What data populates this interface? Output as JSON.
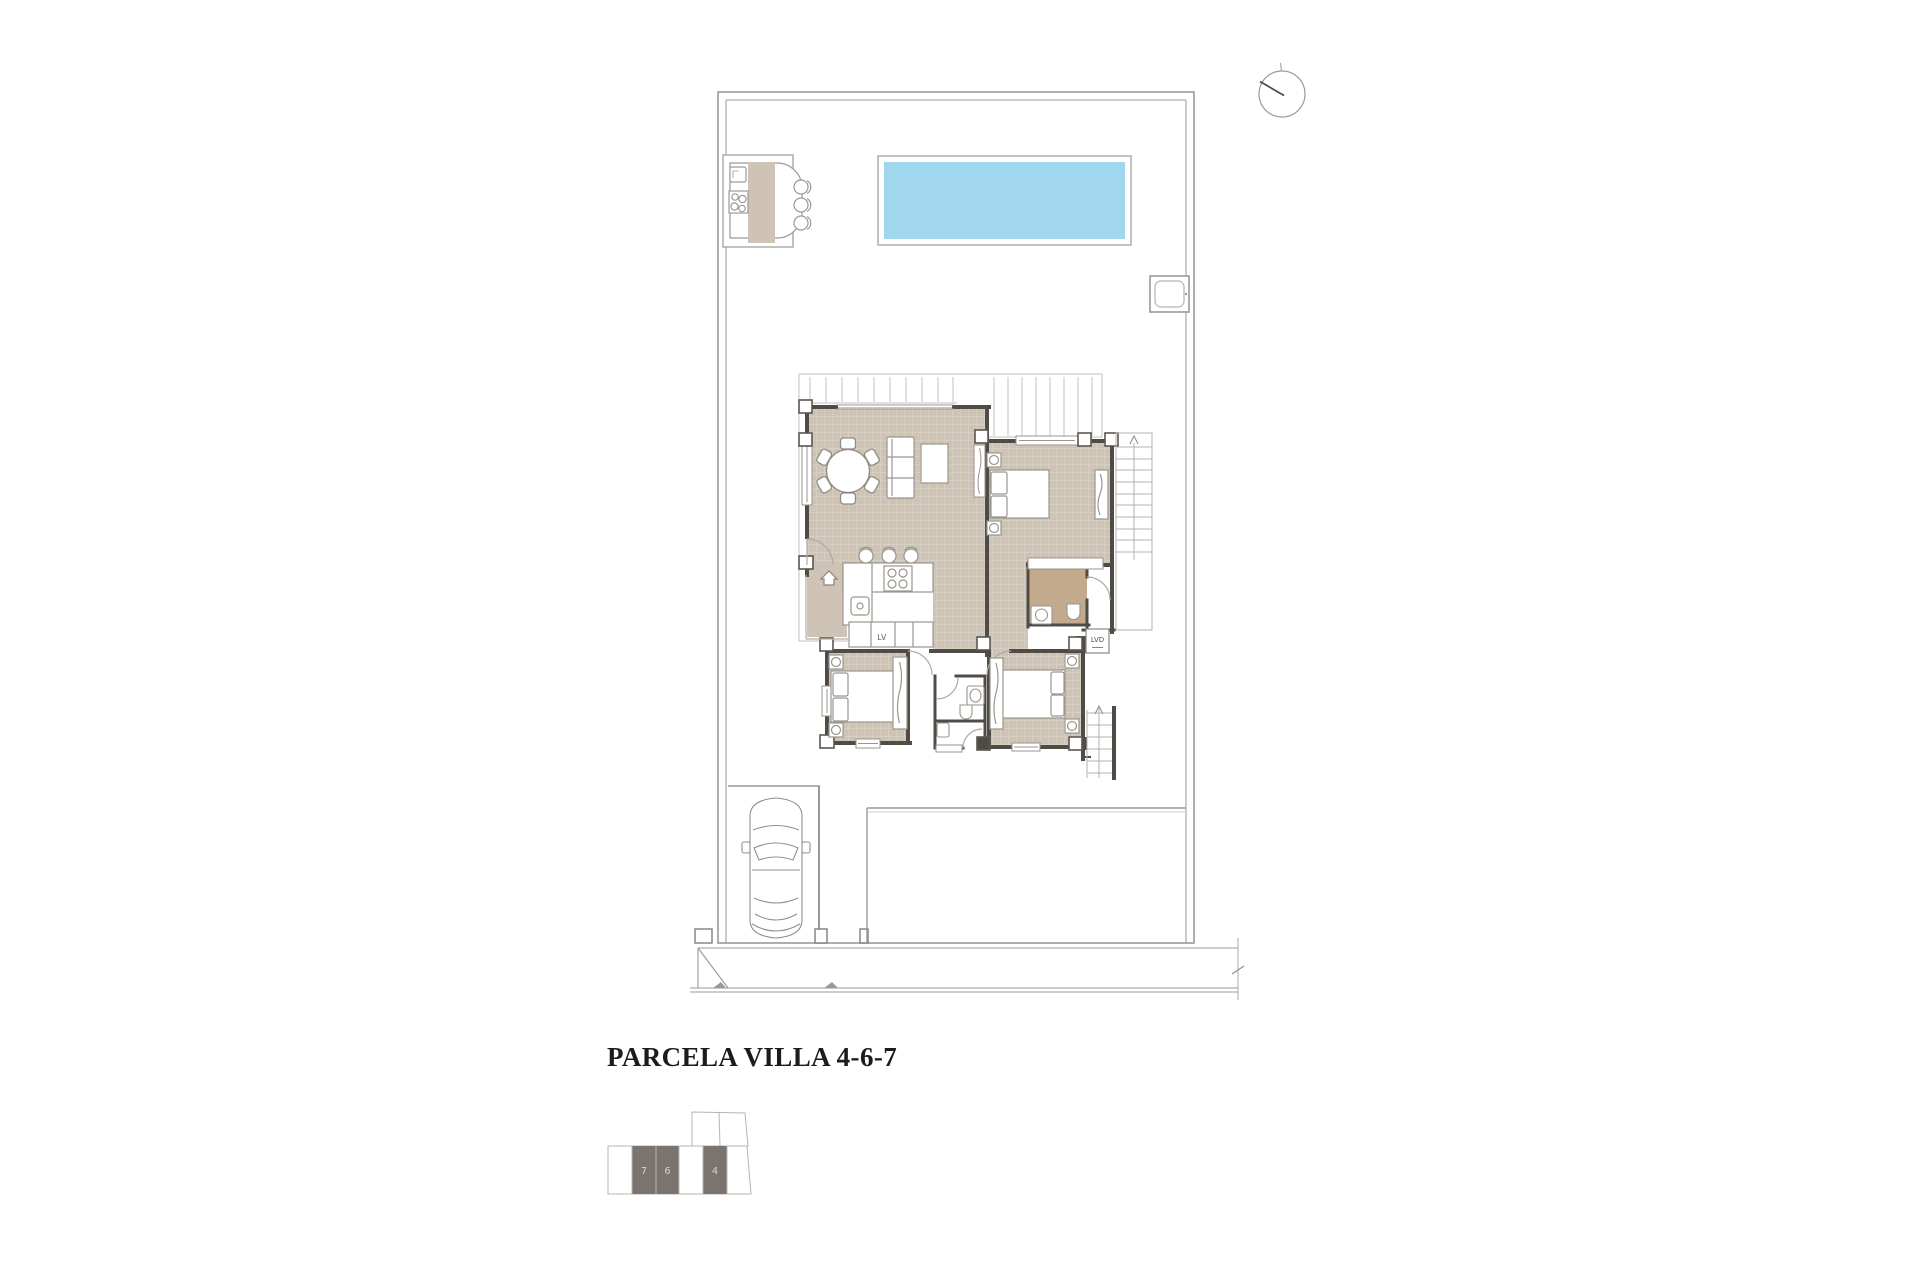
{
  "title": {
    "text": "PARCELA VILLA 4-6-7"
  },
  "plan": {
    "labels": {
      "dishwasher": "LV",
      "laundry": "LVD"
    },
    "colors": {
      "floor": "#cec3b4",
      "bath_floor": "#c3aa8c",
      "pool": "#a0d6ee",
      "wall": "#4f4b47",
      "outline": "#9a9a9a",
      "keyplan_highlight": "#7a7370",
      "keyplan_number": "#d9d5d3"
    }
  },
  "key_plan": {
    "units": [
      {
        "label": "7"
      },
      {
        "label": "6"
      },
      {
        "label": "4"
      }
    ]
  }
}
